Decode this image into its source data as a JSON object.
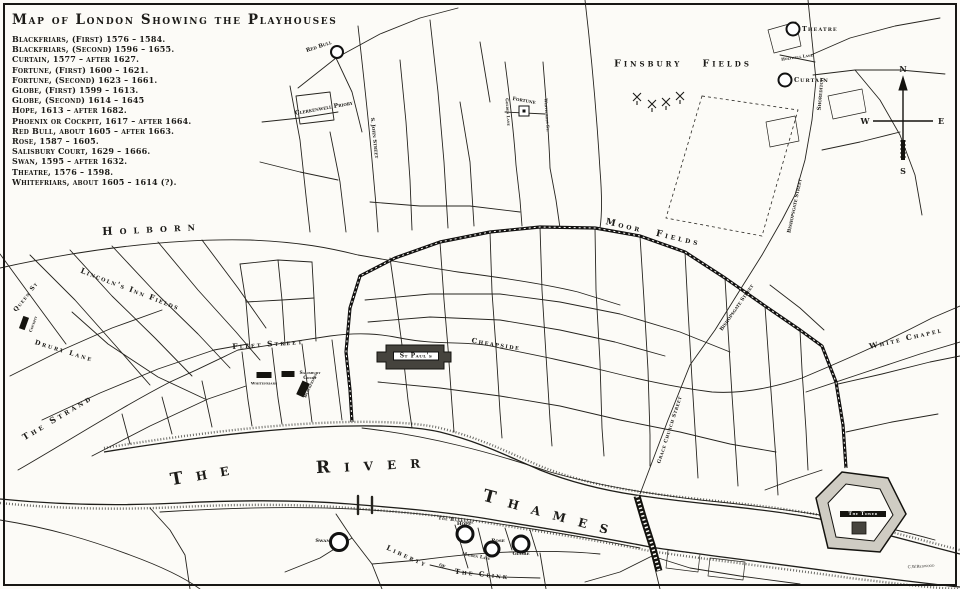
{
  "title": "Map of London Showing the Playhouses",
  "legend": [
    "Blackfriars, (First) 1576 – 1584.",
    "Blackfriars, (Second) 1596 – 1655.",
    "Curtain, 1577 – after 1627.",
    "Fortune, (First) 1600 – 1621.",
    "Fortune, (Second) 1623 – 1661.",
    "Globe, (First) 1599 – 1613.",
    "Globe, (Second) 1614 – 1645",
    "Hope, 1613 – after 1682.",
    "Phoenix or Cockpit, 1617 – after 1664.",
    "Red Bull, about 1605 – after 1663.",
    "Rose, 1587 – 1605.",
    "Salisbury Court, 1629 – 1666.",
    "Swan, 1595 – after 1632.",
    "Theatre, 1576 – 1598.",
    "Whitefriars, about 1605 – 1614 (?)."
  ],
  "places": {
    "finsbury_fields": "Finsbury Fields",
    "moor_fields": "Moor Fields",
    "holborn": "Holborn",
    "lincolns_inn_fields": "Lincoln's Inn Fields",
    "queen_st": "Queen St",
    "drury_lane": "Drury Lane",
    "fleet_street": "Fleet Street",
    "the_strand": "The Strand",
    "cheapside": "Cheapside",
    "white_chapel": "White Chapel",
    "grace_church_street": "Grace Church Street",
    "bishopsgate_street": "Bishopsgate Street",
    "shoreditch": "Shoreditch",
    "holywell_lane": "Holywell Lane",
    "st_john_street": "S. John Street",
    "clerkenwell_priory": "Clerkenwell Priory",
    "golden_lane": "Golden Lane",
    "whitecross_street": "Whitecross St.",
    "the_bankside": "The Bankside",
    "maiden_lane": "Maiden Lane",
    "liberty": "Liberty",
    "of": "of",
    "the_clink": "The Clink",
    "st_pauls": "St Paul's",
    "the_tower": "The Tower",
    "river_the": "The",
    "river_river": "River",
    "river_thames": "Thames"
  },
  "playhouses": {
    "theatre": "Theatre",
    "curtain": "Curtain",
    "red_bull": "Red Bull",
    "fortune": "Fortune",
    "cockpit": "Cockpit",
    "whitefriars": "Whitefriars",
    "salisbury_court": "Salisbury Court",
    "blackfriars": "Blackfriars",
    "swan": "Swan",
    "hope": "Hope",
    "rose": "Rose",
    "globe": "Globe"
  },
  "compass": {
    "n": "N",
    "s": "S",
    "e": "E",
    "w": "W"
  },
  "signature": "C.W.Redwood",
  "colors": {
    "ink": "#1c1b18",
    "paper": "#fcfbf7"
  }
}
